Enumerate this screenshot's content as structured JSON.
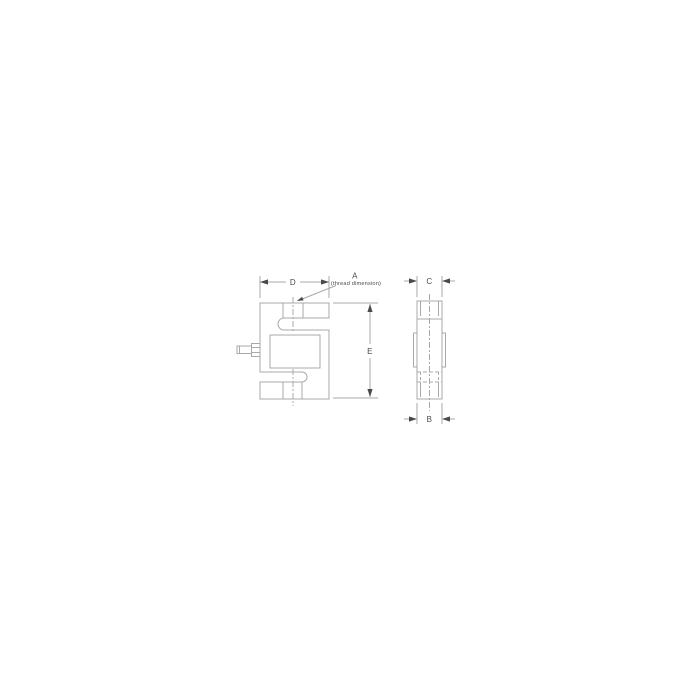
{
  "drawing": {
    "labels": {
      "dim_width_top": "D",
      "dim_thread": "A",
      "dim_thread_note": "(thread dimension)",
      "dim_height": "E",
      "dim_depth_top": "C",
      "dim_depth_bottom": "B"
    },
    "colors": {
      "background": "#ffffff",
      "line": "#a9a9a9",
      "annotation": "#4a4a4a"
    }
  }
}
